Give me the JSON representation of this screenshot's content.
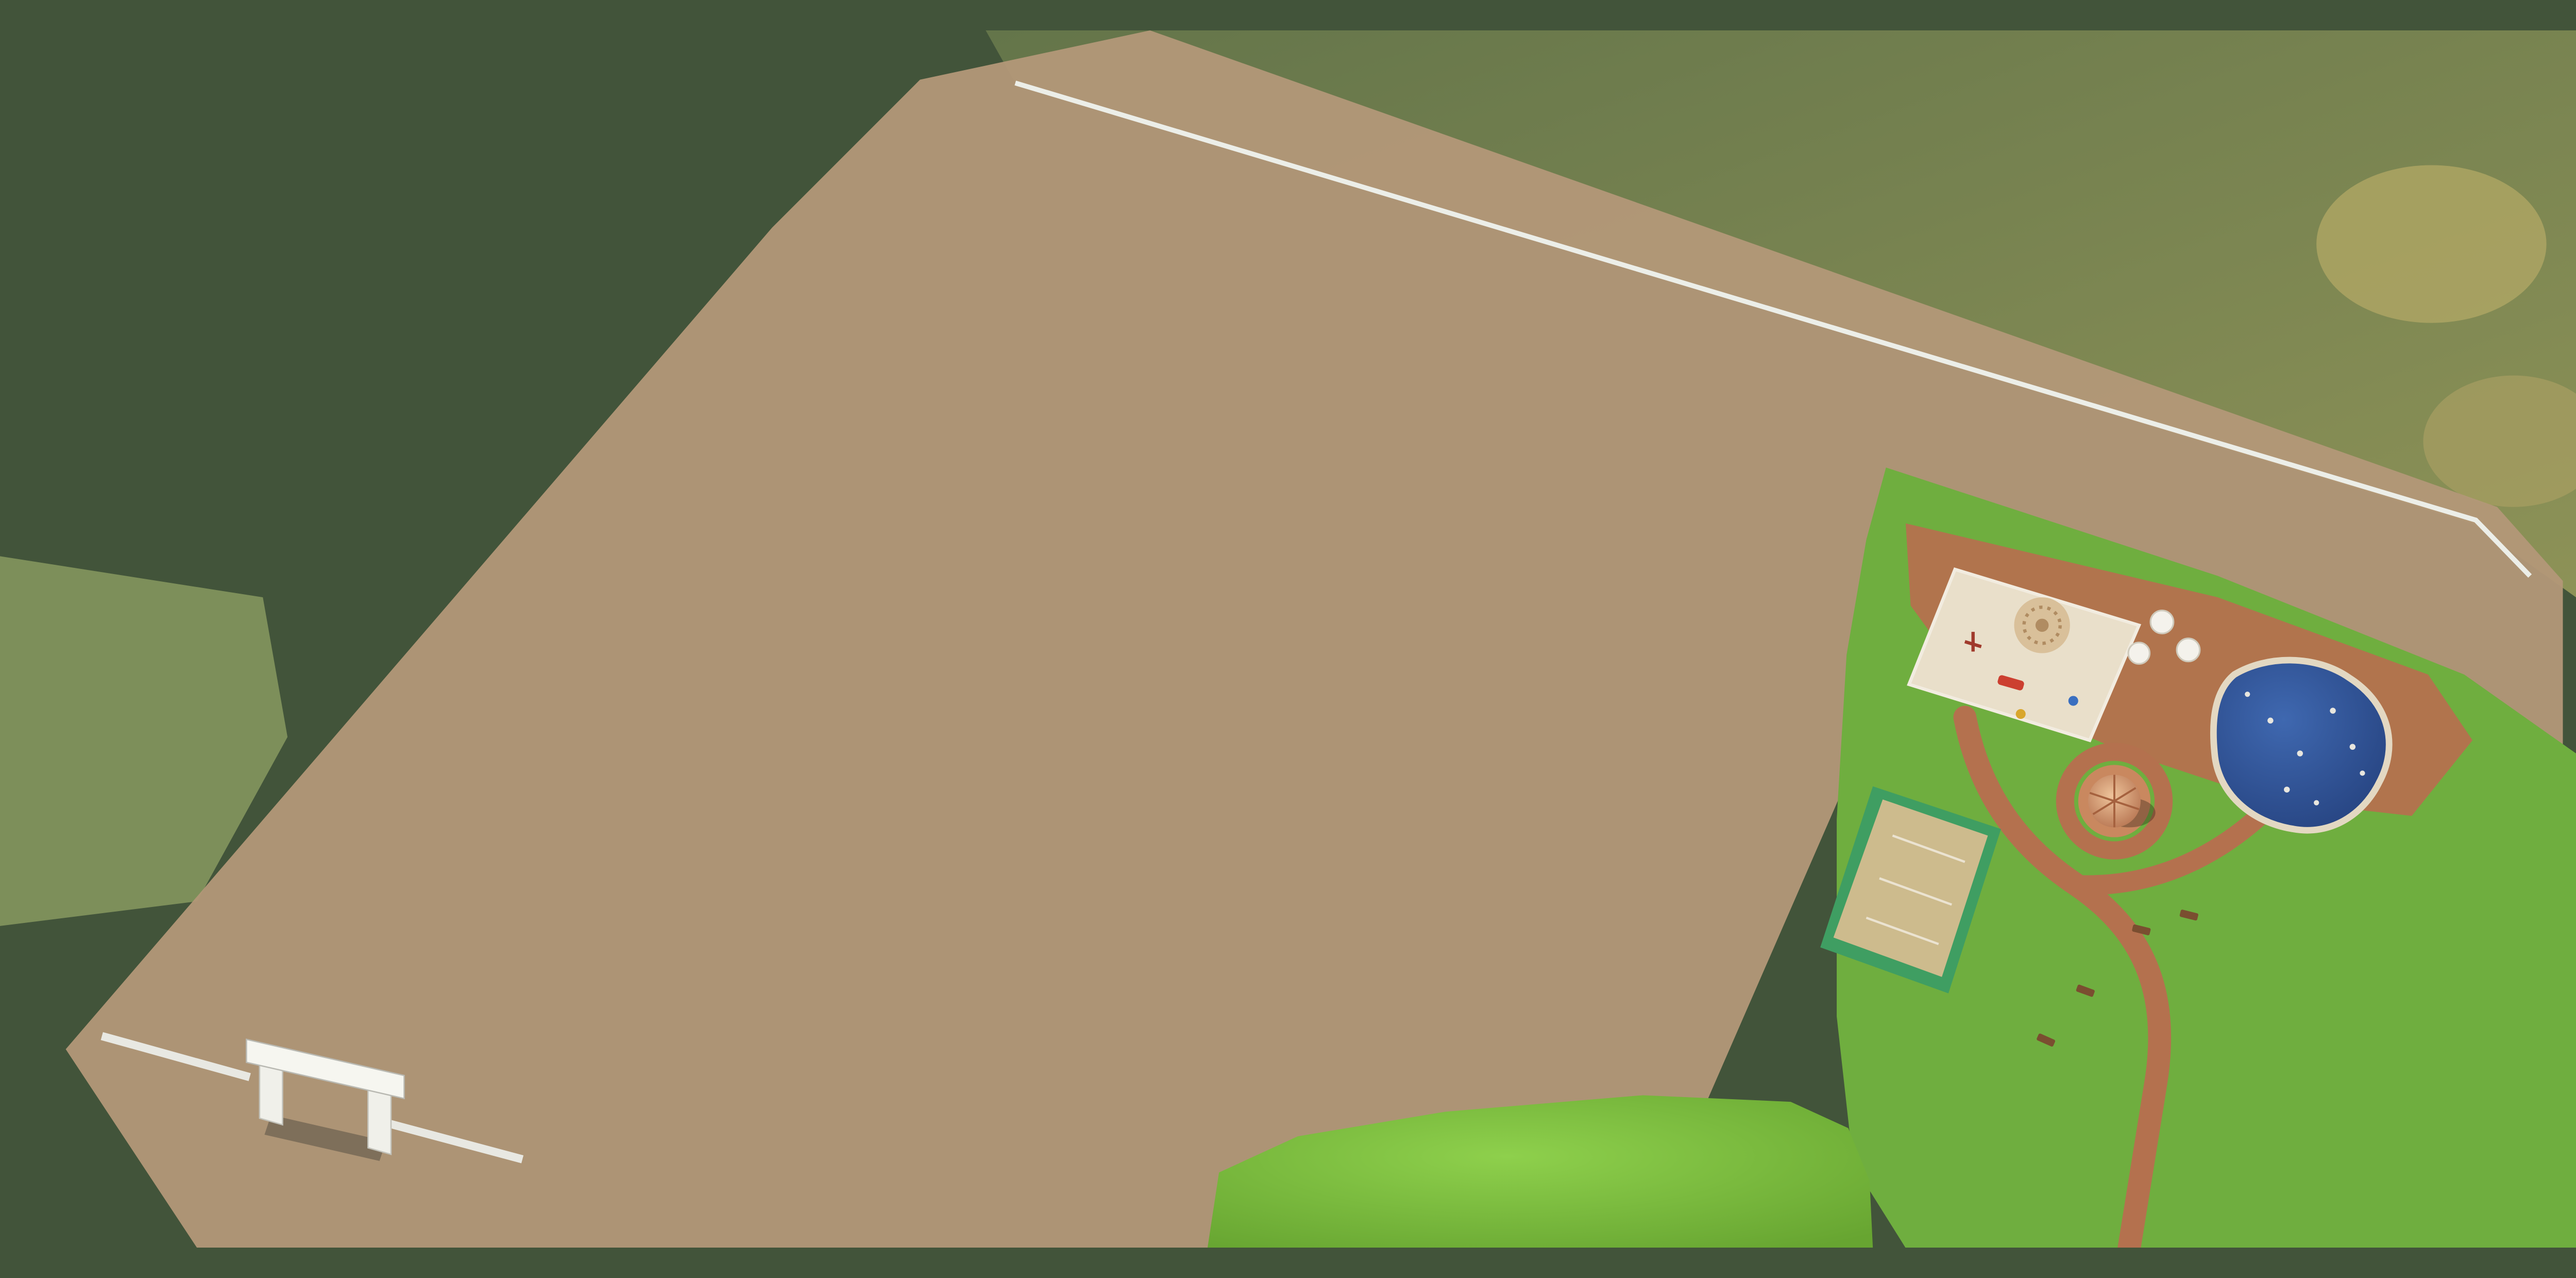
{
  "scene": {
    "type": "aerial-3d-site-plan-rendering",
    "development": "residential plotted layout with numbered plots, internal roads and amenity park"
  },
  "plots": {
    "left_column": [
      "13",
      "12",
      "11",
      "10",
      "9",
      "8",
      "7",
      "6",
      "5",
      "4",
      "3",
      "2",
      "1"
    ],
    "west_corner": [
      "15",
      "14"
    ],
    "junction_corner": [
      "16",
      "17"
    ],
    "north_row": [
      "18",
      "19",
      "20",
      "21",
      "22",
      "23",
      "24",
      "25",
      "26",
      "27"
    ],
    "mid_west_column": [
      "45",
      "46",
      "47",
      "48",
      "49",
      "50",
      "51",
      "52",
      "53",
      "54",
      "55",
      "56"
    ],
    "mid_east_column": [
      "44",
      "43",
      "42",
      "41",
      "40",
      "39",
      "38",
      "37",
      "36",
      "35",
      "34"
    ],
    "east_block": [
      "28",
      "29",
      "30",
      "31",
      "32",
      "33"
    ],
    "labels_hidden_by_trees": [
      "14",
      "34"
    ],
    "total_plots": 56
  },
  "amenities": [
    {
      "name": "entrance-gate",
      "description": "white arched gateway over entry road, bottom-left"
    },
    {
      "name": "playground",
      "description": "sand play area with mandala paving, red slide, swings"
    },
    {
      "name": "gazebo",
      "description": "round hut with conical terracotta roof on circular brick pad"
    },
    {
      "name": "swimming-pool",
      "description": "freeform blue pool with swimmers"
    },
    {
      "name": "sport-court",
      "description": "khaki court with green trim"
    },
    {
      "name": "lawn",
      "description": "bright green open lawns"
    },
    {
      "name": "walking-paths",
      "description": "curving terracotta paths"
    },
    {
      "name": "umbrella-seating",
      "description": "white parasols in planters"
    }
  ],
  "vehicles": [
    {
      "type": "car",
      "color_name": "blue",
      "location": "crosswalk at north junction"
    },
    {
      "type": "car",
      "color_name": "white",
      "location": "junction plaza"
    },
    {
      "type": "van",
      "color_name": "silver-blue",
      "location": "crosswalk at road fork"
    },
    {
      "type": "car",
      "color_name": "dark-gray",
      "location": "main east road"
    },
    {
      "type": "car",
      "color_name": "blue",
      "location": "west road"
    },
    {
      "type": "car",
      "color_name": "white",
      "location": "center road"
    },
    {
      "type": "pickup-truck",
      "color_name": "orange",
      "location": "east road near park"
    },
    {
      "type": "car",
      "color_name": "white",
      "location": "parked under trees, east"
    }
  ],
  "road_features": [
    "dashed-center-lines",
    "zebra-crosswalks",
    "street-lights",
    "roadside-trees",
    "pedestrian-stairs"
  ],
  "environment": [
    "dense-forest-surround",
    "fog-clouds-top-left",
    "dry-meadow-top-right",
    "olive-meadow-left"
  ],
  "colors": {
    "plot_light": "#c2a787",
    "plot_dark": "#a5815f",
    "plot_wall": "#eff1ec",
    "road_asphalt": "#5f6366",
    "road_marking": "#eceae2",
    "forest_base": "#42543a",
    "lawn_bright": "#7cc13d",
    "amenity_lawn": "#6fae3f",
    "terracotta_path": "#b4714e",
    "pool_water": "#2b4f94",
    "court_surface": "#cdbb8d",
    "court_trim": "#3f9e62",
    "sand": "#e9dfca",
    "cloud": "#ffffff",
    "label_text": "#f7f4ec"
  }
}
